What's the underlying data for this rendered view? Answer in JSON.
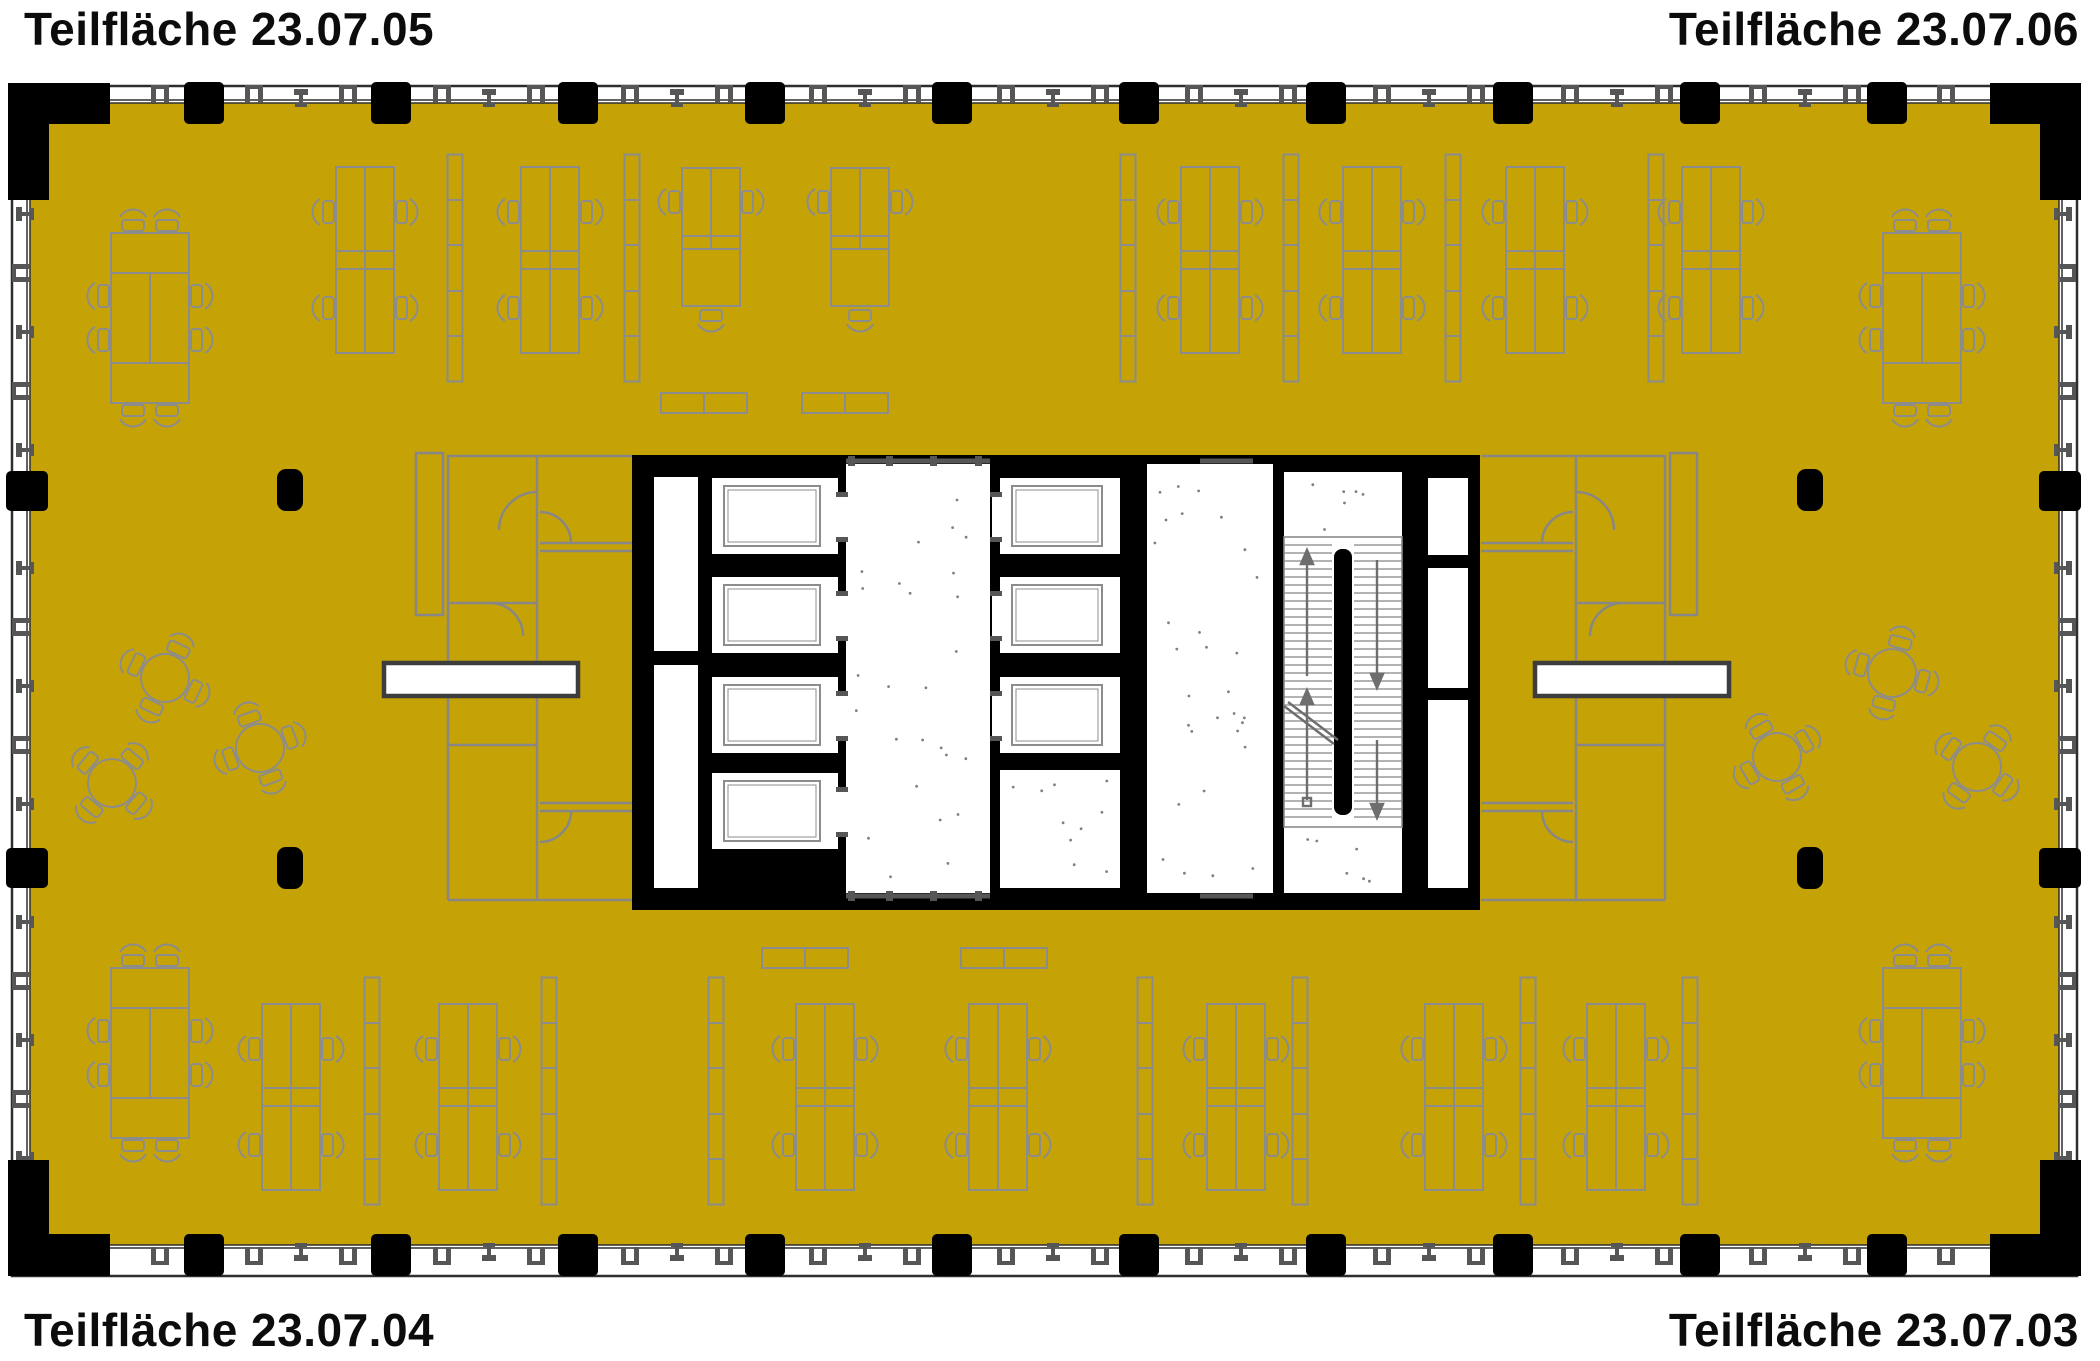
{
  "labels": {
    "top_left": "Teilfläche 23.07.05",
    "top_right": "Teilfläche 23.07.06",
    "bottom_left": "Teilfläche 23.07.04",
    "bottom_right": "Teilfläche 23.07.03"
  },
  "colors": {
    "background": "#ffffff",
    "zone_fill": "#c5a206",
    "wall_black": "#000000",
    "furniture_gray": "#8c8c8c",
    "partition_gray": "#878787",
    "fitting_gray": "#565656",
    "facade_line": "#2e2e2e",
    "bar_border": "#3d3d3d",
    "tread_gray": "#9a9a9a"
  },
  "plan": {
    "perimeter": {
      "column_xs": [
        204,
        391,
        578,
        765,
        952,
        1139,
        1326,
        1513,
        1700,
        1887
      ],
      "column_side_ys": [
        491,
        868
      ],
      "top_cy": 103,
      "bottom_cy": 1255,
      "left_cx": 27,
      "right_cx": 2060
    },
    "interior_pillars": [
      {
        "cx": 290,
        "cy": 490
      },
      {
        "cx": 290,
        "cy": 868
      },
      {
        "cx": 1810,
        "cy": 490
      },
      {
        "cx": 1810,
        "cy": 868
      }
    ],
    "desk_clusters": [
      {
        "cx": 365,
        "cy": 260,
        "type": "quad"
      },
      {
        "cx": 550,
        "cy": 260,
        "type": "quad"
      },
      {
        "cx": 711,
        "cy": 237,
        "type": "duo"
      },
      {
        "cx": 860,
        "cy": 237,
        "type": "duo"
      },
      {
        "cx": 1210,
        "cy": 260,
        "type": "quad"
      },
      {
        "cx": 1372,
        "cy": 260,
        "type": "quad"
      },
      {
        "cx": 1535,
        "cy": 260,
        "type": "quad"
      },
      {
        "cx": 1711,
        "cy": 260,
        "type": "quad"
      },
      {
        "cx": 291,
        "cy": 1097,
        "type": "quad"
      },
      {
        "cx": 468,
        "cy": 1097,
        "type": "quad"
      },
      {
        "cx": 825,
        "cy": 1097,
        "type": "quad"
      },
      {
        "cx": 998,
        "cy": 1097,
        "type": "quad"
      },
      {
        "cx": 1236,
        "cy": 1097,
        "type": "quad"
      },
      {
        "cx": 1454,
        "cy": 1097,
        "type": "quad"
      },
      {
        "cx": 1616,
        "cy": 1097,
        "type": "quad"
      }
    ],
    "shelves_v": [
      {
        "cx": 455,
        "cy": 268
      },
      {
        "cx": 632,
        "cy": 268
      },
      {
        "cx": 1128,
        "cy": 268
      },
      {
        "cx": 1291,
        "cy": 268
      },
      {
        "cx": 1453,
        "cy": 268
      },
      {
        "cx": 1656,
        "cy": 268
      },
      {
        "cx": 372,
        "cy": 1091
      },
      {
        "cx": 549,
        "cy": 1091
      },
      {
        "cx": 716,
        "cy": 1091
      },
      {
        "cx": 1145,
        "cy": 1091
      },
      {
        "cx": 1300,
        "cy": 1091
      },
      {
        "cx": 1528,
        "cy": 1091
      },
      {
        "cx": 1690,
        "cy": 1091
      }
    ],
    "shelves_h": [
      {
        "cx": 704,
        "cy": 403
      },
      {
        "cx": 845,
        "cy": 403
      },
      {
        "cx": 805,
        "cy": 958
      },
      {
        "cx": 1004,
        "cy": 958
      }
    ],
    "conference_tables": [
      {
        "cx": 150,
        "cy": 318
      },
      {
        "cx": 1922,
        "cy": 318
      },
      {
        "cx": 150,
        "cy": 1053
      },
      {
        "cx": 1922,
        "cy": 1053
      }
    ],
    "round_tables": [
      {
        "cx": 165,
        "cy": 678,
        "rot": 25
      },
      {
        "cx": 260,
        "cy": 748,
        "rot": -20
      },
      {
        "cx": 112,
        "cy": 783,
        "rot": 40
      },
      {
        "cx": 1892,
        "cy": 673,
        "rot": 15
      },
      {
        "cx": 1777,
        "cy": 757,
        "rot": -30
      },
      {
        "cx": 1977,
        "cy": 767,
        "rot": 35
      }
    ],
    "white_bars": [
      {
        "x": 384,
        "y": 663,
        "w": 194,
        "h": 33
      },
      {
        "x": 1535,
        "y": 663,
        "w": 194,
        "h": 33
      }
    ],
    "elevators": {
      "bank_ys": [
        478,
        577,
        677,
        773
      ],
      "shaft_h": 76,
      "left": {
        "x": 712,
        "w": 126,
        "count": 4
      },
      "right": {
        "x": 1000,
        "w": 120,
        "count": 3
      }
    },
    "core": {
      "x": 632,
      "y": 455,
      "w": 848,
      "h": 455
    }
  }
}
